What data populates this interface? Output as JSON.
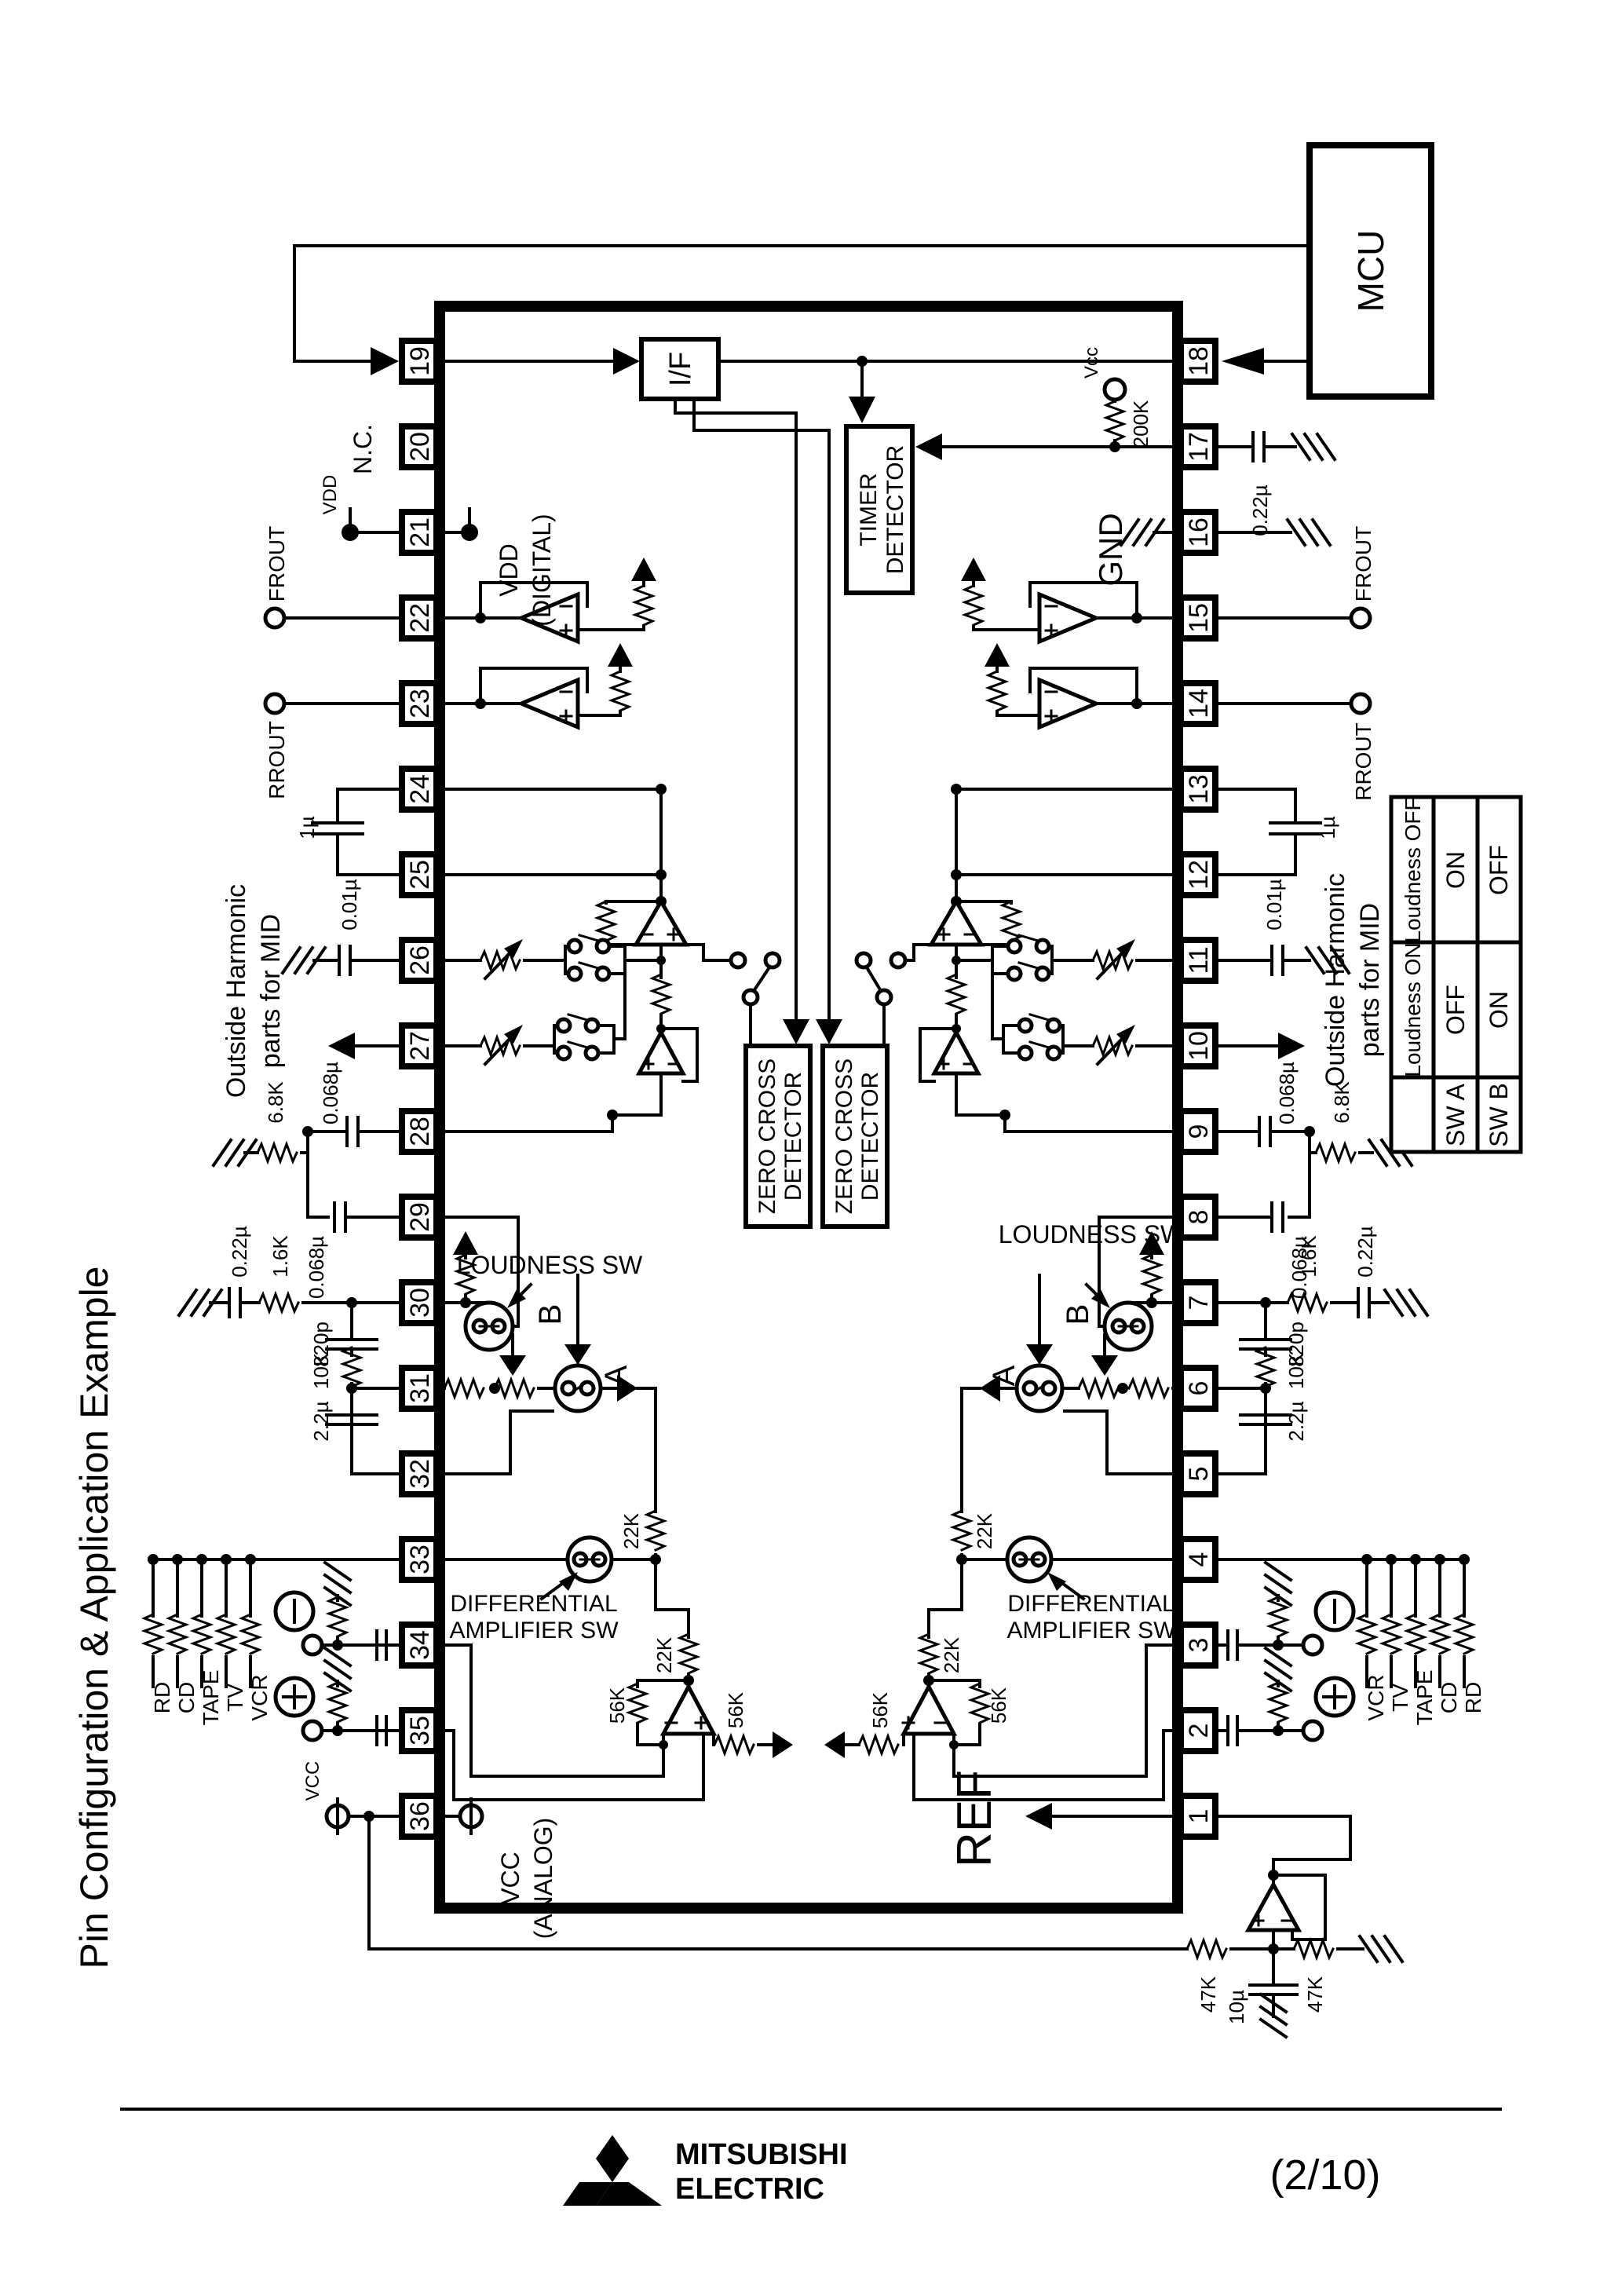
{
  "title": "Pin Configuration & Application Example",
  "mcu": "MCU",
  "blocks": {
    "iface": "I/F",
    "timer1": "TIMER",
    "timer2": "DETECTOR",
    "zc1": "ZERO CROSS",
    "zc2": "DETECTOR",
    "ref": "REF"
  },
  "pins_left": [
    "19",
    "20",
    "21",
    "22",
    "23",
    "24",
    "25",
    "26",
    "27",
    "28",
    "29",
    "30",
    "31",
    "32",
    "33",
    "34",
    "35",
    "36"
  ],
  "pins_right": [
    "18",
    "17",
    "16",
    "15",
    "14",
    "13",
    "12",
    "11",
    "10",
    "9",
    "8",
    "7",
    "6",
    "5",
    "4",
    "3",
    "2",
    "1"
  ],
  "labels": {
    "nc": "N.C.",
    "vdd": "VDD",
    "vdd_in1": "VDD",
    "vdd_in2": "(DIGITAL)",
    "vcc": "VCC",
    "vcc_in1": "VCC",
    "vcc_in2": "(ANALOG)",
    "vcc_small": "Vcc",
    "gnd": "GND",
    "frout": "FROUT",
    "rrout": "RROUT",
    "harm1": "Outside Harmonic",
    "harm2": "parts for MID",
    "loudness": "LOUDNESS SW",
    "a": "A",
    "b": "B",
    "diff1": "DIFFERENTIAL",
    "diff2": "AMPLIFIER SW"
  },
  "values": {
    "c1u": "1µ",
    "c001": "0.01µ",
    "c068": "0.068µ",
    "r68": "6.8K",
    "c022": "0.22µ",
    "r16": "1.6K",
    "c820": "820p",
    "r10k": "10K",
    "c22u": "2.2µ",
    "r200k": "200K",
    "r22k": "22K",
    "r56k": "56K",
    "r47k": "47K",
    "c10u": "10µ"
  },
  "sources_left": [
    "RD",
    "CD",
    "TAPE",
    "TV",
    "VCR"
  ],
  "sources_right": [
    "VCR",
    "TV",
    "TAPE",
    "CD",
    "RD"
  ],
  "table": {
    "r1": [
      "Loudness OFF",
      "ON",
      "OFF"
    ],
    "r2": [
      "Loudness ON",
      "OFF",
      "ON"
    ],
    "r3": [
      "SW A",
      "SW B"
    ]
  },
  "footer": {
    "brand1": "MITSUBISHI",
    "brand2": "ELECTRIC",
    "page": "(2/10)"
  }
}
